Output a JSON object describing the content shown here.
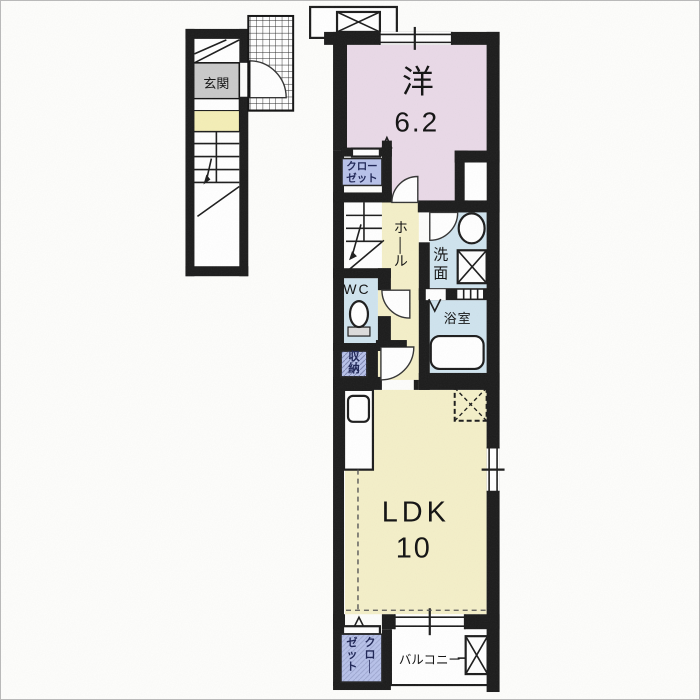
{
  "floor_plan": {
    "first_floor": {
      "entrance": {
        "label": "玄関"
      }
    },
    "rooms": {
      "western_room": {
        "label": "洋",
        "size": "6.2"
      },
      "closet_upper": {
        "line1": "クロー",
        "line2": "ゼット"
      },
      "hall": {
        "label": "ホール"
      },
      "washroom": {
        "label": "洗面"
      },
      "bathroom": {
        "label": "浴室"
      },
      "wc": {
        "label": "WC"
      },
      "storage": {
        "label": "収納"
      },
      "ldk": {
        "label": "LDK",
        "size": "10"
      },
      "closet_lower": {
        "col_right": "クロー",
        "col_left": "ゼット"
      },
      "balcony": {
        "label": "バルコニー"
      }
    },
    "colors": {
      "wall": "#1b1b1b",
      "room_pink": "#e9d9e7",
      "room_cream": "#f4efc8",
      "room_blue": "#cfe3ee",
      "label_periwinkle": "#b7c1e9",
      "entrance_gray": "#c9c9c9",
      "strip_yellow": "#f4eeb6",
      "paper": "#fdfdfb",
      "label_text": "#1d2455"
    }
  }
}
